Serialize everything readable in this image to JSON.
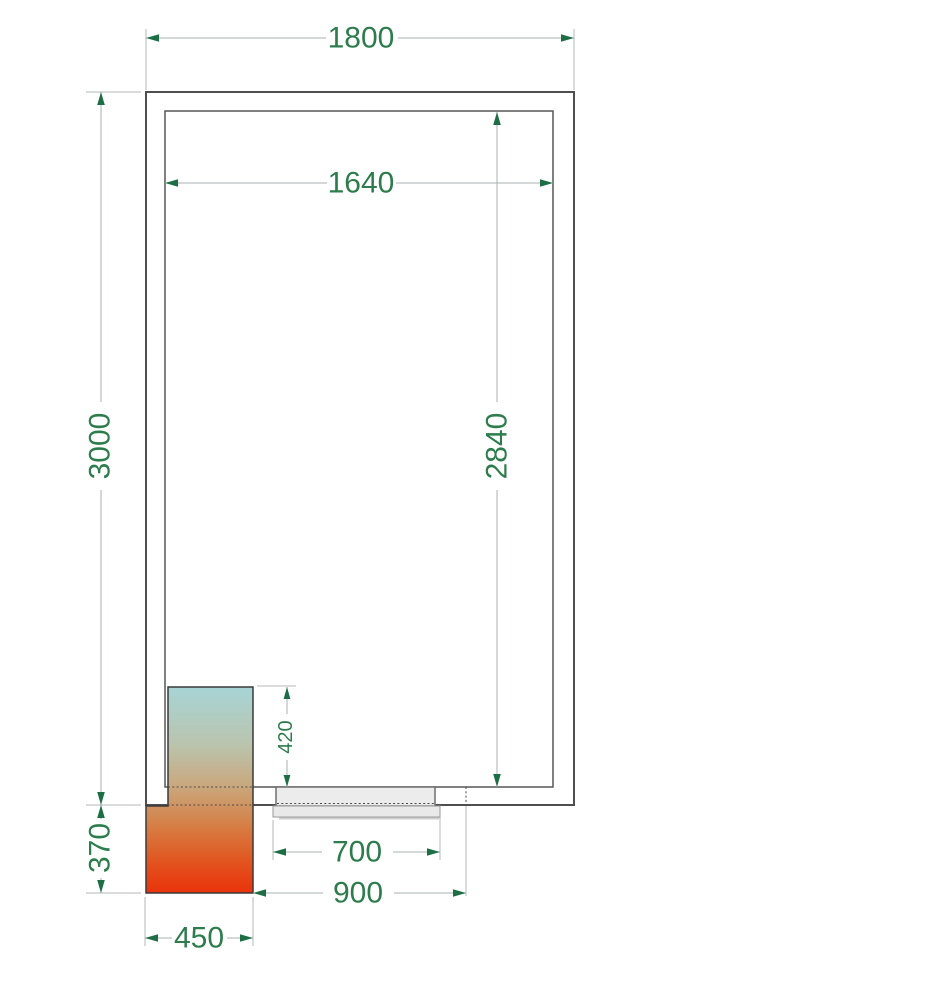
{
  "drawing": {
    "kind": "cold-room-floor-plan",
    "dimensions": {
      "outer_width": "1800",
      "inner_width": "1640",
      "outer_depth": "3000",
      "inner_depth": "2840",
      "unit_inside_depth": "420",
      "unit_outside_depth": "370",
      "door_width": "700",
      "door_offset": "900",
      "unit_width": "450"
    },
    "colors": {
      "dimension_text": "#2d7c4c",
      "arrow": "#1d6e45",
      "wall_line": "#4f4f4f",
      "dimension_line": "#abb1b1",
      "door_fill": "#ececec",
      "unit_gradient_top": "#a7d4d6",
      "unit_gradient_mid": "#c9a87e",
      "unit_gradient_bottom": "#ea320b"
    }
  }
}
